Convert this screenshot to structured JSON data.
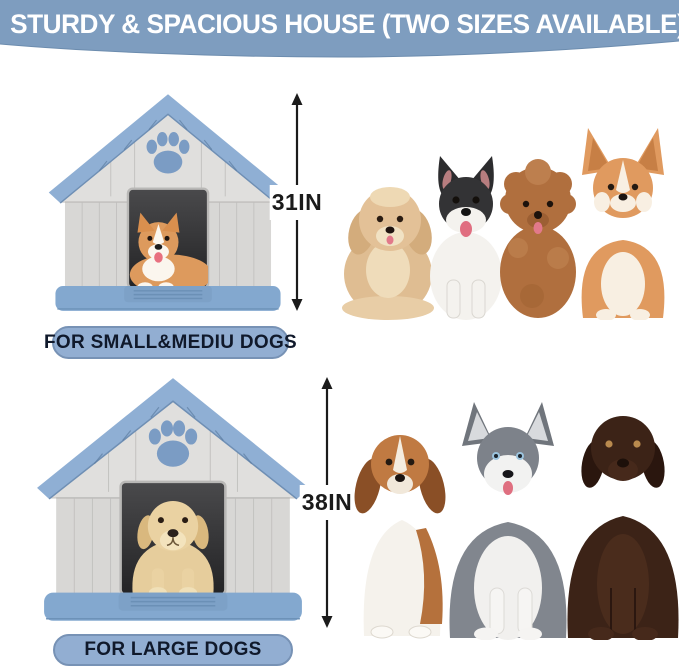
{
  "banner": {
    "title": "STURDY & SPACIOUS HOUSE (TWO SIZES AVAILABLE)"
  },
  "small_house": {
    "height_label": "31IN",
    "badge_label": "FOR SMALL&MEDIU DOGS",
    "house_icon": "small-dog-house-with-corgi-inside",
    "dogs_icon": "small-breed-dogs-group (havanese, french bulldog, poodle, corgi)"
  },
  "large_house": {
    "height_label": "38IN",
    "badge_label": "FOR LARGE DOGS",
    "house_icon": "large-dog-house-with-labrador-inside",
    "dogs_icon": "large-breed-dogs-group (beagle, husky, chocolate labrador)"
  },
  "colors": {
    "banner-bg": "#7e9dbf",
    "banner-text": "#ffffff",
    "badge-bg": "#92aed2",
    "badge-border": "#7792b5",
    "badge-text": "#10192b",
    "arrow-color": "#1b1b1b",
    "house-wall": "#d8d7d5",
    "house-gable": "#e0dfdd",
    "house-roof": "#8fafd4",
    "house-base": "#83a8cf",
    "paw-blue": "#7b9cc4",
    "door-dark": "#3a3a3c"
  }
}
